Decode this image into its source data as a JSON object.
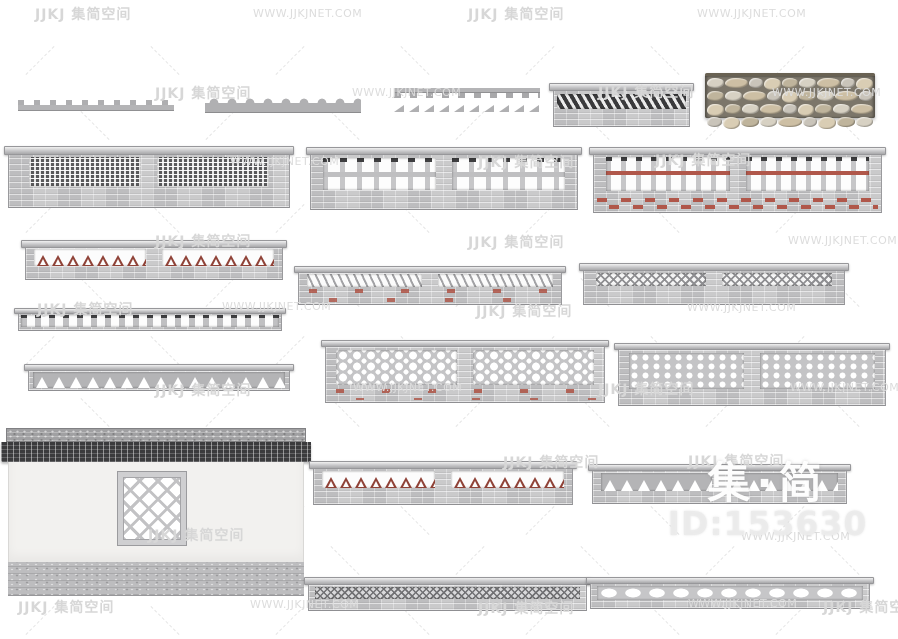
{
  "watermarks": {
    "logo_text": "JJKJ 集简空间",
    "site_url": "WWW.JJKJNET.COM",
    "color": "#d8d8d8",
    "instances": [
      {
        "t": "cn",
        "x": 35,
        "y": 4
      },
      {
        "t": "url",
        "x": 253,
        "y": 7
      },
      {
        "t": "cn",
        "x": 468,
        "y": 4
      },
      {
        "t": "url",
        "x": 697,
        "y": 7
      },
      {
        "t": "cn",
        "x": 155,
        "y": 83
      },
      {
        "t": "url",
        "x": 352,
        "y": 86
      },
      {
        "t": "cn",
        "x": 598,
        "y": 82
      },
      {
        "t": "url",
        "x": 772,
        "y": 86
      },
      {
        "t": "url",
        "x": 230,
        "y": 155
      },
      {
        "t": "cn",
        "x": 478,
        "y": 152
      },
      {
        "t": "cn",
        "x": 655,
        "y": 150
      },
      {
        "t": "cn",
        "x": 155,
        "y": 231
      },
      {
        "t": "cn",
        "x": 468,
        "y": 232
      },
      {
        "t": "url",
        "x": 788,
        "y": 234
      },
      {
        "t": "cn",
        "x": 37,
        "y": 299
      },
      {
        "t": "url",
        "x": 222,
        "y": 300
      },
      {
        "t": "cn",
        "x": 476,
        "y": 301
      },
      {
        "t": "url",
        "x": 687,
        "y": 301
      },
      {
        "t": "cn",
        "x": 155,
        "y": 380
      },
      {
        "t": "url",
        "x": 353,
        "y": 381
      },
      {
        "t": "cn",
        "x": 598,
        "y": 379
      },
      {
        "t": "url",
        "x": 790,
        "y": 381
      },
      {
        "t": "cn",
        "x": 503,
        "y": 452
      },
      {
        "t": "cn",
        "x": 688,
        "y": 451
      },
      {
        "t": "cn",
        "x": 148,
        "y": 525
      },
      {
        "t": "url",
        "x": 741,
        "y": 530
      },
      {
        "t": "cn",
        "x": 18,
        "y": 597
      },
      {
        "t": "url",
        "x": 250,
        "y": 598
      },
      {
        "t": "cn",
        "x": 478,
        "y": 598
      },
      {
        "t": "url",
        "x": 688,
        "y": 597
      },
      {
        "t": "cn",
        "x": 823,
        "y": 597
      }
    ]
  },
  "overlay": {
    "brand": "集·简",
    "model_id": "ID:153630"
  },
  "palette": {
    "background": "#ffffff",
    "brick_gray": "#c5c5c7",
    "dark_tile": "#3a3a3c",
    "accent_red": "#9a4a3d",
    "stone_tan": "#cdbfa4",
    "plaster_white": "#f2f1ef",
    "watermark_gray": "#d8d8d8"
  }
}
